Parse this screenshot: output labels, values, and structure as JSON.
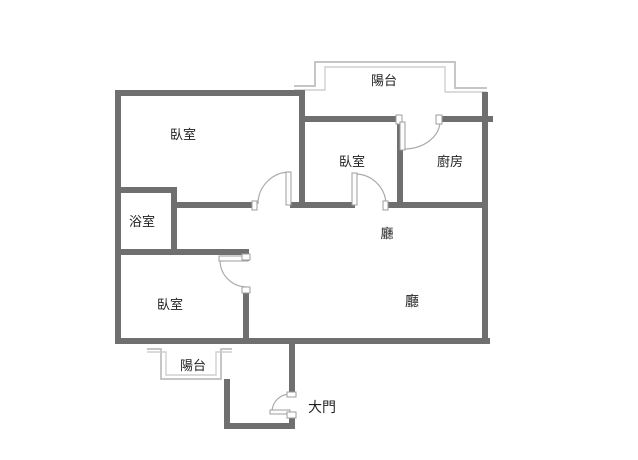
{
  "floor_plan": {
    "type": "apartment-floor-plan",
    "labels": {
      "balcony_top": "陽台",
      "bedroom_top_left": "臥室",
      "bedroom_middle": "臥室",
      "kitchen": "廚房",
      "bathroom": "浴室",
      "hall_upper": "廳",
      "bedroom_bottom_left": "臥室",
      "hall_lower": "廳",
      "balcony_bottom": "陽台",
      "main_door": "大門"
    },
    "colors": {
      "wall": "#6f6f6f",
      "thin_wall": "#bdbdbd",
      "door_stroke": "#ababab",
      "text": "#1f1f1f",
      "background": "#ffffff"
    }
  }
}
